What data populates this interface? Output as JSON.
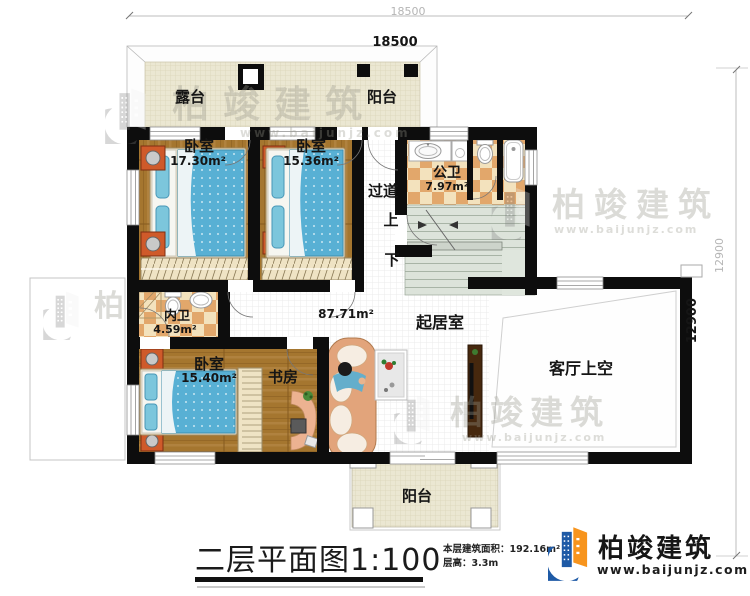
{
  "dims": {
    "top_outer": "18500",
    "top_inner": "18500",
    "right_outer": "12900",
    "right_inner": "12900"
  },
  "rooms": {
    "terrace": "露台",
    "balcony_top": "阳台",
    "bedroom1_name": "卧室",
    "bedroom1_area": "17.30m²",
    "bedroom2_name": "卧室",
    "bedroom2_area": "15.36m²",
    "public_bath_name": "公卫",
    "public_bath_area": "7.97m²",
    "corridor": "过道",
    "stair_up": "上",
    "stair_down": "下",
    "ensuite_name": "内卫",
    "ensuite_area": "4.59m²",
    "bedroom3_name": "卧室",
    "bedroom3_area": "15.40m²",
    "study": "书房",
    "living_name": "起居室",
    "living_area": "87.71m²",
    "void_label": "客厅上空",
    "balcony_bottom": "阳台"
  },
  "footer": {
    "title": "二层平面图1:100",
    "stat_area": "本层建筑面积：192.16m²",
    "stat_height": "层高：3.3m",
    "brand": "柏竣建筑",
    "url": "www.baijunjz.com"
  },
  "watermarks": {
    "brand": "柏竣建筑",
    "url": "www.baijunjz.com"
  },
  "colors": {
    "wall": "#0d0d0d",
    "wood": "#a5762f",
    "tile_dark": "#e2a76b",
    "tile_light": "#f3e2bd",
    "mattress": "#58b0d4",
    "stair": "#dce3da",
    "terrace": "#ebe7d2",
    "brand_blue": "#1e5aa6",
    "brand_orange": "#f7941d"
  }
}
